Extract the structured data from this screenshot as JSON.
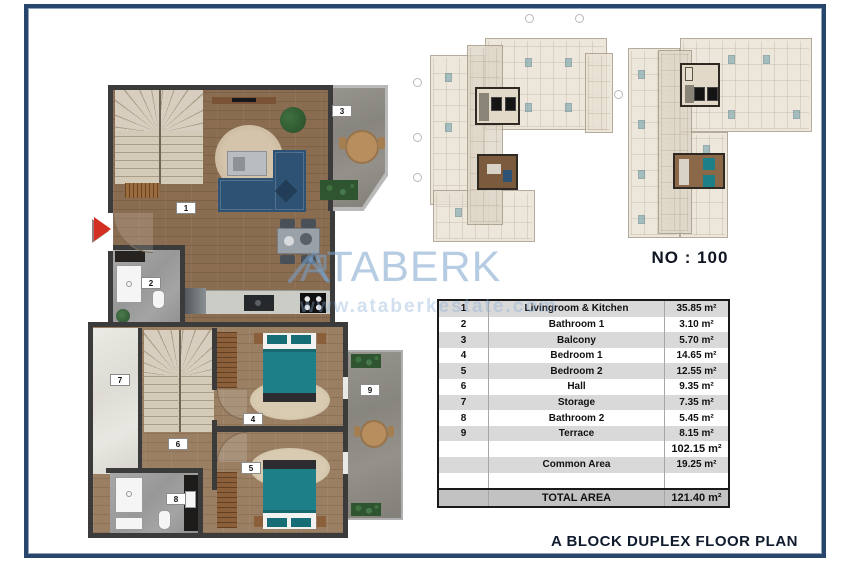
{
  "watermark": {
    "brand": "ATABERK",
    "url": "www.ataberkestate.com"
  },
  "key_plan": {
    "unit_no": "NO : 100"
  },
  "footer": {
    "title": "A BLOCK DUPLEX FLOOR PLAN"
  },
  "upper_plan": {
    "labels": {
      "living": "1",
      "bathroom": "2",
      "balcony": "3"
    }
  },
  "lower_plan": {
    "labels": {
      "bedroom1": "4",
      "bedroom2": "5",
      "hall": "6",
      "storage": "7",
      "bathroom": "8",
      "terrace": "9"
    }
  },
  "area_table": {
    "rows": [
      {
        "num": "1",
        "name": "Livingroom & Kitchen",
        "area": "35.85 m²"
      },
      {
        "num": "2",
        "name": "Bathroom 1",
        "area": "3.10 m²"
      },
      {
        "num": "3",
        "name": "Balcony",
        "area": "5.70 m²"
      },
      {
        "num": "4",
        "name": "Bedroom 1",
        "area": "14.65 m²"
      },
      {
        "num": "5",
        "name": "Bedroom 2",
        "area": "12.55 m²"
      },
      {
        "num": "6",
        "name": "Hall",
        "area": "9.35 m²"
      },
      {
        "num": "7",
        "name": "Storage",
        "area": "7.35 m²"
      },
      {
        "num": "8",
        "name": "Bathroom 2",
        "area": "5.45 m²"
      },
      {
        "num": "9",
        "name": "Terrace",
        "area": "8.15 m²"
      },
      {
        "num": "",
        "name": "",
        "area": "102.15 m²"
      },
      {
        "num": "",
        "name": "Common Area",
        "area": "19.25 m²"
      },
      {
        "num": "",
        "name": "",
        "area": ""
      },
      {
        "num": "",
        "name": "TOTAL AREA",
        "area": "121.40 m²"
      }
    ]
  },
  "colors": {
    "frame_navy": "#28456b",
    "wall_dark": "#3b3b3b",
    "sofa_navy": "#2e5274",
    "bed_teal": "#1d7f88",
    "watermark_blue": "#78a2cc",
    "entrance_arrow_red": "#d32f23"
  }
}
